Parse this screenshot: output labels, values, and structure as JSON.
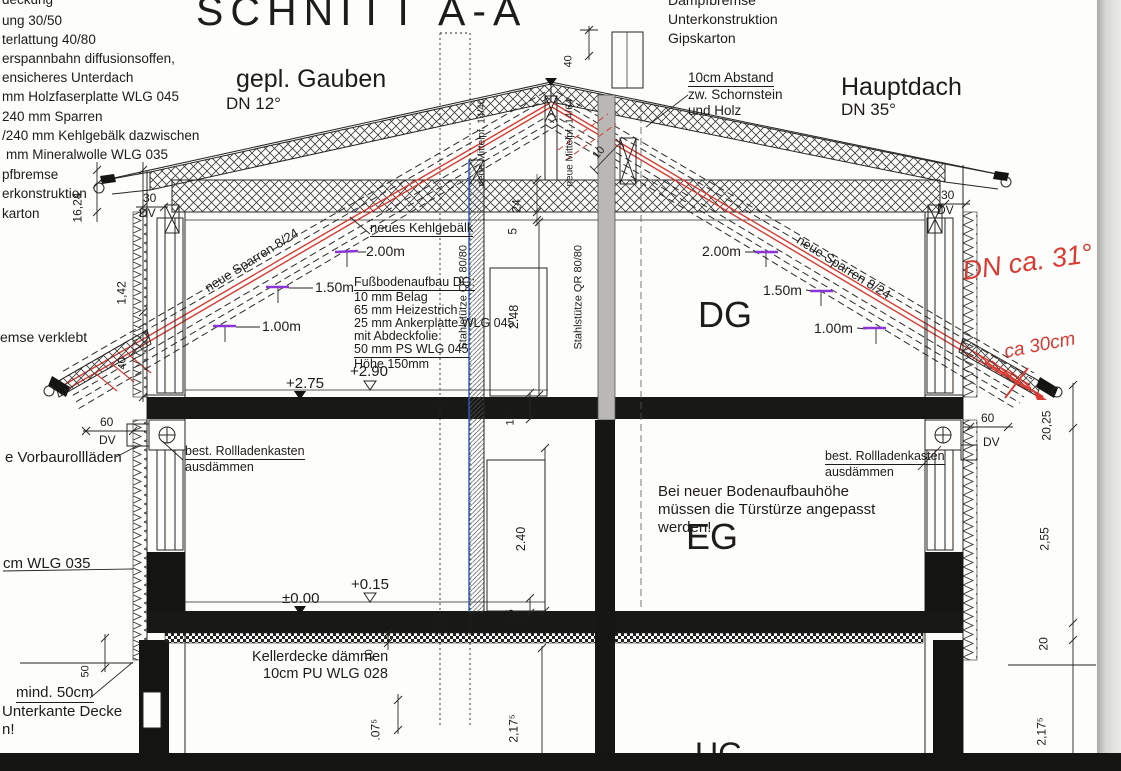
{
  "drawing": {
    "title": "SCHNITT A-A",
    "roof_left": {
      "name": "gepl. Gauben",
      "dn": "DN 12°"
    },
    "roof_right": {
      "name": "Hauptdach",
      "dn": "DN 35°"
    },
    "notes_top_left": {
      "lines": [
        "deckung",
        "ung 30/50",
        "terlattung 40/80",
        "erspannbahn diffusionsoffen,",
        "ensicheres Unterdach",
        "mm Holzfaserplatte WLG 045",
        "240 mm  Sparren",
        "/240 mm Kehlgebälk dazwischen",
        "mm Mineralwolle WLG 035",
        "pfbremse",
        "erkonstruktion",
        "karton"
      ]
    },
    "notes_top_center": {
      "lines": [
        "Dampfbremse",
        "Unterkonstruktion",
        "Gipskarton"
      ]
    },
    "note_abstand": {
      "lines": [
        "10cm Abstand",
        "zw. Schornstein",
        "und Holz"
      ]
    },
    "note_kehlgebaelk": "neues Kehlgebälk",
    "sparren_left": "neue Sparren 8/24",
    "sparren_right": "neue Sparren 8/24",
    "mittelpfette_left": "neue Mittelpf. 14/40",
    "mittelpfette_right": "neue Mittelpf. 14/64",
    "stahlstuetze_left": "Stahlstütze QR 80/80",
    "stahlstuetze_right": "Stahlstütze QR 80/80",
    "floor_buildup": {
      "title": "Fußbodenaufbau DG:",
      "lines": [
        "10 mm Belag",
        "65 mm Heizestrich",
        "25 mm Ankerplatte WLG 045",
        "mit Abdeckfolie",
        "50 mm PS WLG 045",
        "Höhe 150mm"
      ]
    },
    "rooms": {
      "dg": "DG",
      "eg": "EG",
      "ug": "UG"
    },
    "levels": {
      "dg_raw": "+2.75",
      "dg_fin": "+2.90",
      "eg_raw": "±0.00",
      "eg_fin": "+0.15"
    },
    "heights_left": [
      "2.00m",
      "1.50m",
      "1.00m"
    ],
    "heights_right": [
      "2.00m",
      "1.50m",
      "1.00m"
    ],
    "note_rollladen_left": {
      "lines": [
        "best. Rollladenkasten",
        "ausdämmen"
      ]
    },
    "note_rollladen_right": {
      "lines": [
        "best. Rollladenkasten",
        "ausdämmen"
      ]
    },
    "note_vorbau": "e Vorbaurollläden",
    "note_wlg": "cm WLG 035",
    "note_verklebt": "emse verklebt",
    "note_keller": {
      "lines": [
        "Kellerdecke dämmen",
        "10cm PU WLG 028"
      ]
    },
    "note_tuersturz": {
      "lines": [
        "Bei neuer Bodenaufbauhöhe",
        "müssen die Türstürze angepasst",
        "werden!"
      ]
    },
    "note_mind50": {
      "lines": [
        "mind. 50cm",
        "Unterkante Decke",
        "n!"
      ]
    },
    "red_notes": {
      "dn": "DN ca. 31°",
      "abstand": "ca 30cm"
    },
    "dimensions": {
      "roof_left_30": "30",
      "roof_left_dv": "DV",
      "roof_right_30": "30",
      "roof_right_dv": "DV",
      "chimney_top_40": "40",
      "chimney_wood_10": "10",
      "ceiling_24": "24",
      "ceiling_5": "5",
      "left_16_24": "16,24",
      "left_1_42": "1,42",
      "left_40": "40",
      "left_50": "50",
      "wall_left_60": "60",
      "wall_left_dv": "DV",
      "wall_right_60": "60",
      "wall_right_dv": "DV",
      "room_dg_248": "2.48",
      "room_eg_240": "2.40",
      "slab_dg_15": "15",
      "slab_eg_15": "15",
      "keller_10": "10",
      "bottom_075": ".07⁵",
      "bottom_2175": "2,17⁵",
      "right_2025": "20,25",
      "right_255": "2,55",
      "right_20": "20",
      "right_2175": "2,17⁵"
    },
    "colors": {
      "red": "#d93b33",
      "purple": "#8b35d8",
      "blue": "#2b59c3"
    }
  }
}
